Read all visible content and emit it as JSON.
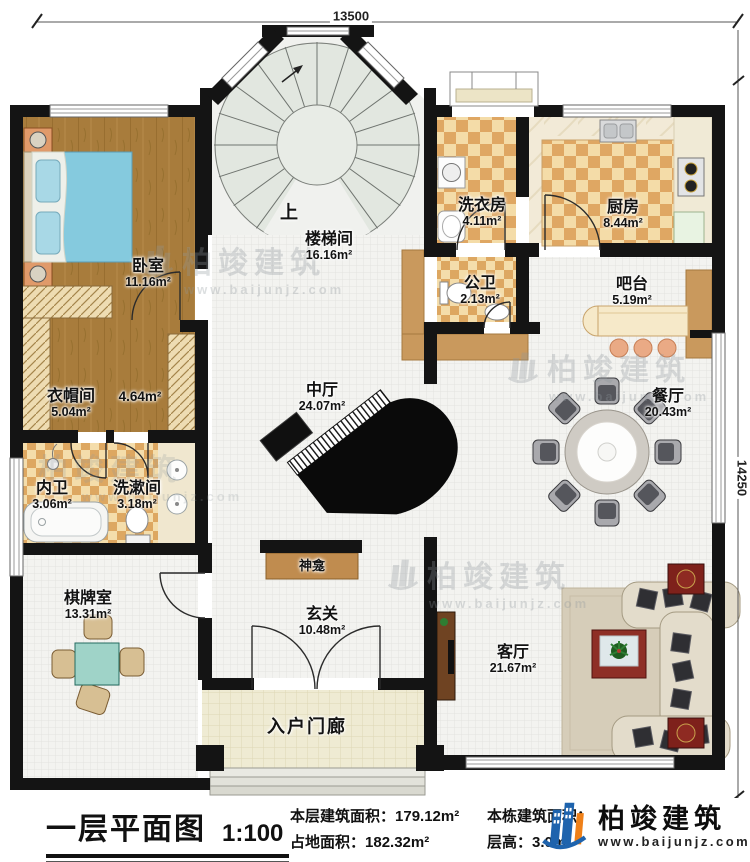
{
  "dimensions": {
    "top": "13500",
    "right": "14250"
  },
  "stair": {
    "up_label": "上"
  },
  "rooms": [
    {
      "name": "卧室",
      "area": "11.16m²"
    },
    {
      "name": "衣帽间",
      "area": "5.04m²"
    },
    {
      "name": "",
      "area": "4.64m²"
    },
    {
      "name": "内卫",
      "area": "3.06m²"
    },
    {
      "name": "洗漱间",
      "area": "3.18m²"
    },
    {
      "name": "棋牌室",
      "area": "13.31m²"
    },
    {
      "name": "楼梯间",
      "area": "16.16m²"
    },
    {
      "name": "洗衣房",
      "area": "4.11m²"
    },
    {
      "name": "厨房",
      "area": "8.44m²"
    },
    {
      "name": "公卫",
      "area": "2.13m²"
    },
    {
      "name": "吧台",
      "area": "5.19m²"
    },
    {
      "name": "餐厅",
      "area": "20.43m²"
    },
    {
      "name": "中厅",
      "area": "24.07m²"
    },
    {
      "name": "神龛",
      "area": ""
    },
    {
      "name": "玄关",
      "area": "10.48m²"
    },
    {
      "name": "入户门廊",
      "area": ""
    },
    {
      "name": "客厅",
      "area": "21.67m²"
    }
  ],
  "watermark": {
    "brand": "柏竣建筑",
    "url": "www.baijunjz.com"
  },
  "footer": {
    "title": "一层平面图",
    "scale": "1:100",
    "stats": [
      {
        "label": "本层建筑面积：",
        "value": "179.12m²"
      },
      {
        "label": "占地面积：",
        "value": "182.32m²"
      },
      {
        "label": "本栋建筑面积：",
        "value": ""
      },
      {
        "label": "层高：",
        "value": "3.0m"
      }
    ],
    "brand": {
      "name": "柏竣建筑",
      "url": "www.baijunjz.com"
    }
  },
  "colors": {
    "wall": "#141414",
    "wood_floor": "#a87c3c",
    "tile_checker": "#dfa763",
    "stair_floor": "#e2e7e0",
    "watermark_gray": "#8e979c",
    "brand_blue": "#1e63ad",
    "brand_orange": "#ef8018"
  }
}
